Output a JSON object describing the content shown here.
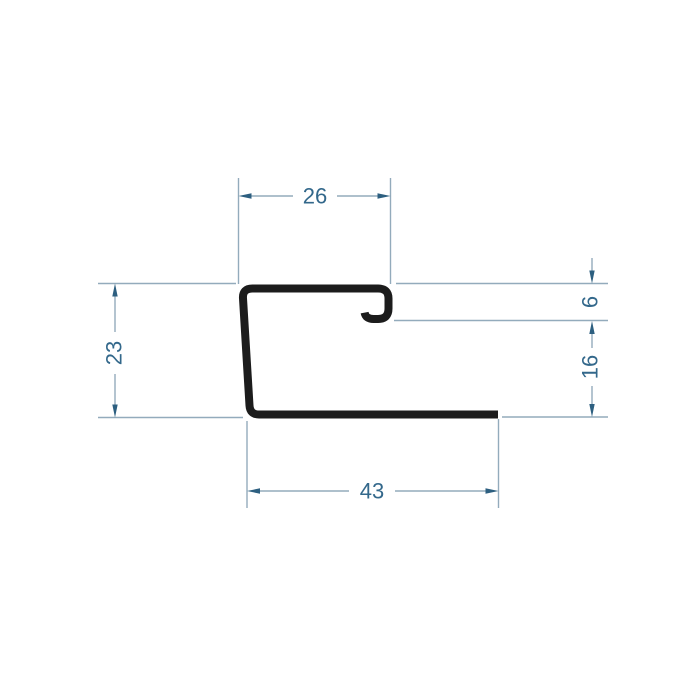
{
  "diagram": {
    "type": "technical-dimension-drawing",
    "subject": "profile-cross-section",
    "dimensions": {
      "top_width": "26",
      "left_height": "23",
      "hook_depth": "6",
      "right_height": "16",
      "bottom_width": "43"
    },
    "colors": {
      "background": "#ffffff",
      "profile": "#1c1c1c",
      "dimension_line": "#93abbc",
      "dimension_arrow": "#2d5f80",
      "dimension_text": "#33688b"
    }
  }
}
